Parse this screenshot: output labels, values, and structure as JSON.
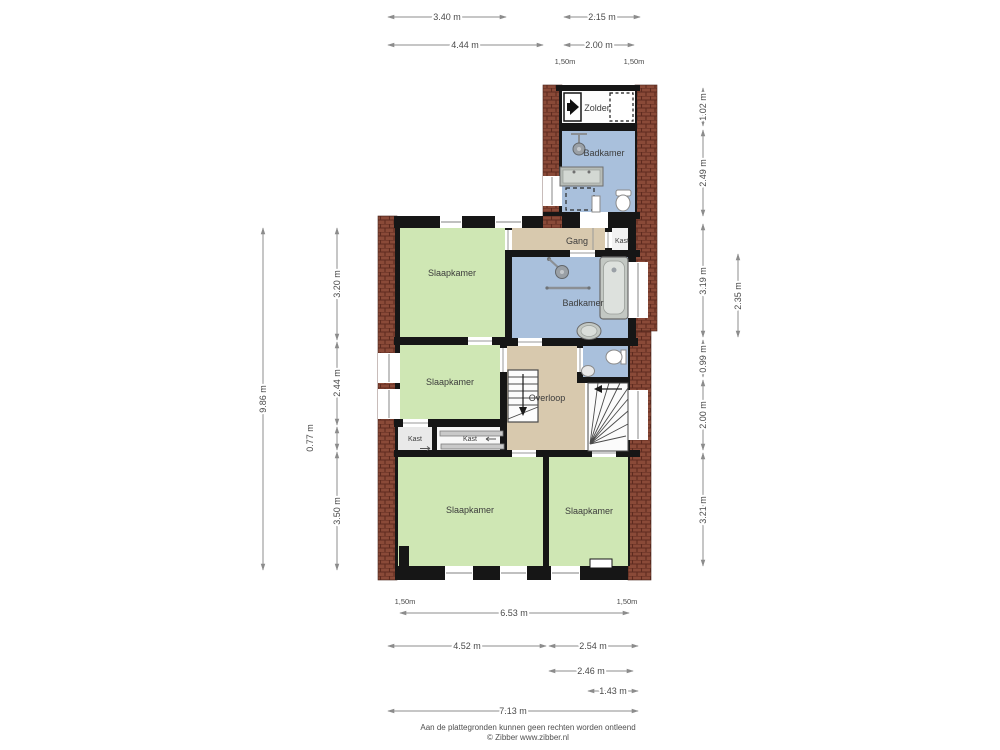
{
  "rooms": {
    "zolder": "Zolder",
    "badkamer_top": "Badkamer",
    "gang": "Gang",
    "kast_gang": "Kast",
    "slaapkamer_nw": "Slaapkamer",
    "badkamer_main": "Badkamer",
    "slaapkamer_w": "Slaapkamer",
    "overloop": "Overloop",
    "kast_left": "Kast",
    "kast_mid": "Kast",
    "slaapkamer_sw": "Slaapkamer",
    "slaapkamer_se": "Slaapkamer"
  },
  "dims": {
    "top": [
      "3.40 m",
      "2.15 m",
      "4.44 m",
      "2.00 m",
      "1,50m",
      "1,50m"
    ],
    "left": [
      "9.86 m",
      "3.20 m",
      "2.44 m",
      "0.77 m",
      "3.50 m"
    ],
    "right": [
      "1.02 m",
      "2.49 m",
      "3.19 m",
      "0.99 m",
      "2.00 m",
      "3.21 m",
      "2.35 m"
    ],
    "bottom": [
      "1,50m",
      "1,50m",
      "6.53 m",
      "4.52 m",
      "2.54 m",
      "2.46 m",
      "1.43 m",
      "7.13 m"
    ]
  },
  "footer": {
    "line1": "Aan de plattegronden kunnen geen rechten worden ontleend",
    "line2": "© Zibber www.zibber.nl"
  },
  "colors": {
    "wall": "#161616",
    "brick": "#8a4a38",
    "brick_mortar": "#5e2b1f",
    "bedroom_green": "#cfe7b4",
    "bath_blue": "#a9c0dc",
    "hall_tan": "#d8c9ae",
    "dim_gray": "#8c8c8c"
  }
}
